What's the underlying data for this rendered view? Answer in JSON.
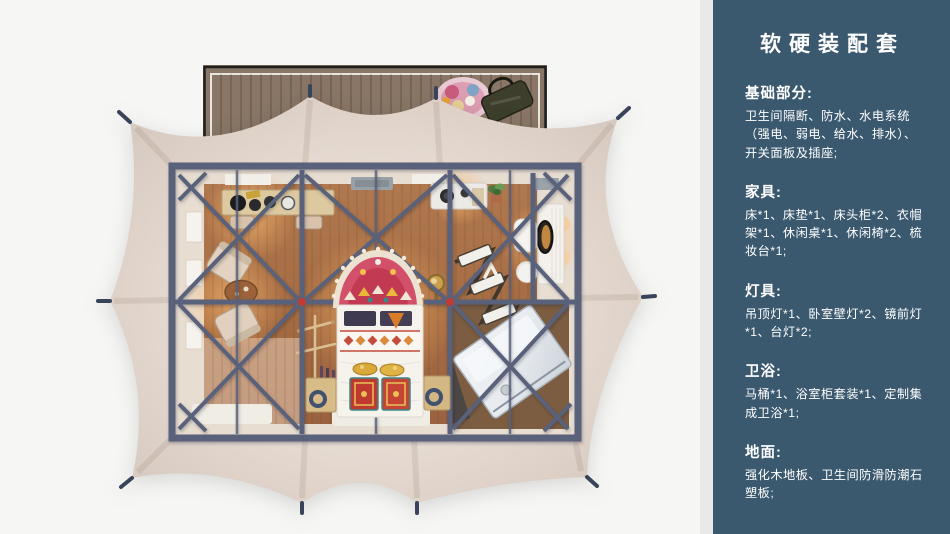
{
  "page": {
    "background": "#f6f6f5"
  },
  "sidebar": {
    "background": "#3a586e",
    "text_color": "#ffffff",
    "title": "软硬装配套",
    "sections": [
      {
        "heading": "基础部分:",
        "body": "卫生间隔断、防水、水电系统（强电、弱电、给水、排水）、开关面板及插座;"
      },
      {
        "heading": "家具:",
        "body": "床*1、床垫*1、床头柜*2、衣帽架*1、休闲桌*1、休闲椅*2、梳妆台*1;"
      },
      {
        "heading": "灯具:",
        "body": "吊顶灯*1、卧室壁灯*2、镜前灯*1、台灯*2;"
      },
      {
        "heading": "卫浴:",
        "body": "马桶*1、浴室柜套装*1、定制集成卫浴*1;"
      },
      {
        "heading": "地面:",
        "body": "强化木地板、卫生间防滑防潮石塑板;"
      }
    ]
  },
  "illustration": {
    "name": "glamping-tent-top-view-floorplan",
    "colors": {
      "canopy": "#e6dbd2",
      "frame": "#59627a",
      "floor_wood": "#a9714a",
      "deck_wood": "#897666",
      "joint_red": "#c23a32",
      "bed_white": "#f6f3ed",
      "rug_pink": "#d2506a",
      "bath_glass": "#e8ebee"
    }
  }
}
